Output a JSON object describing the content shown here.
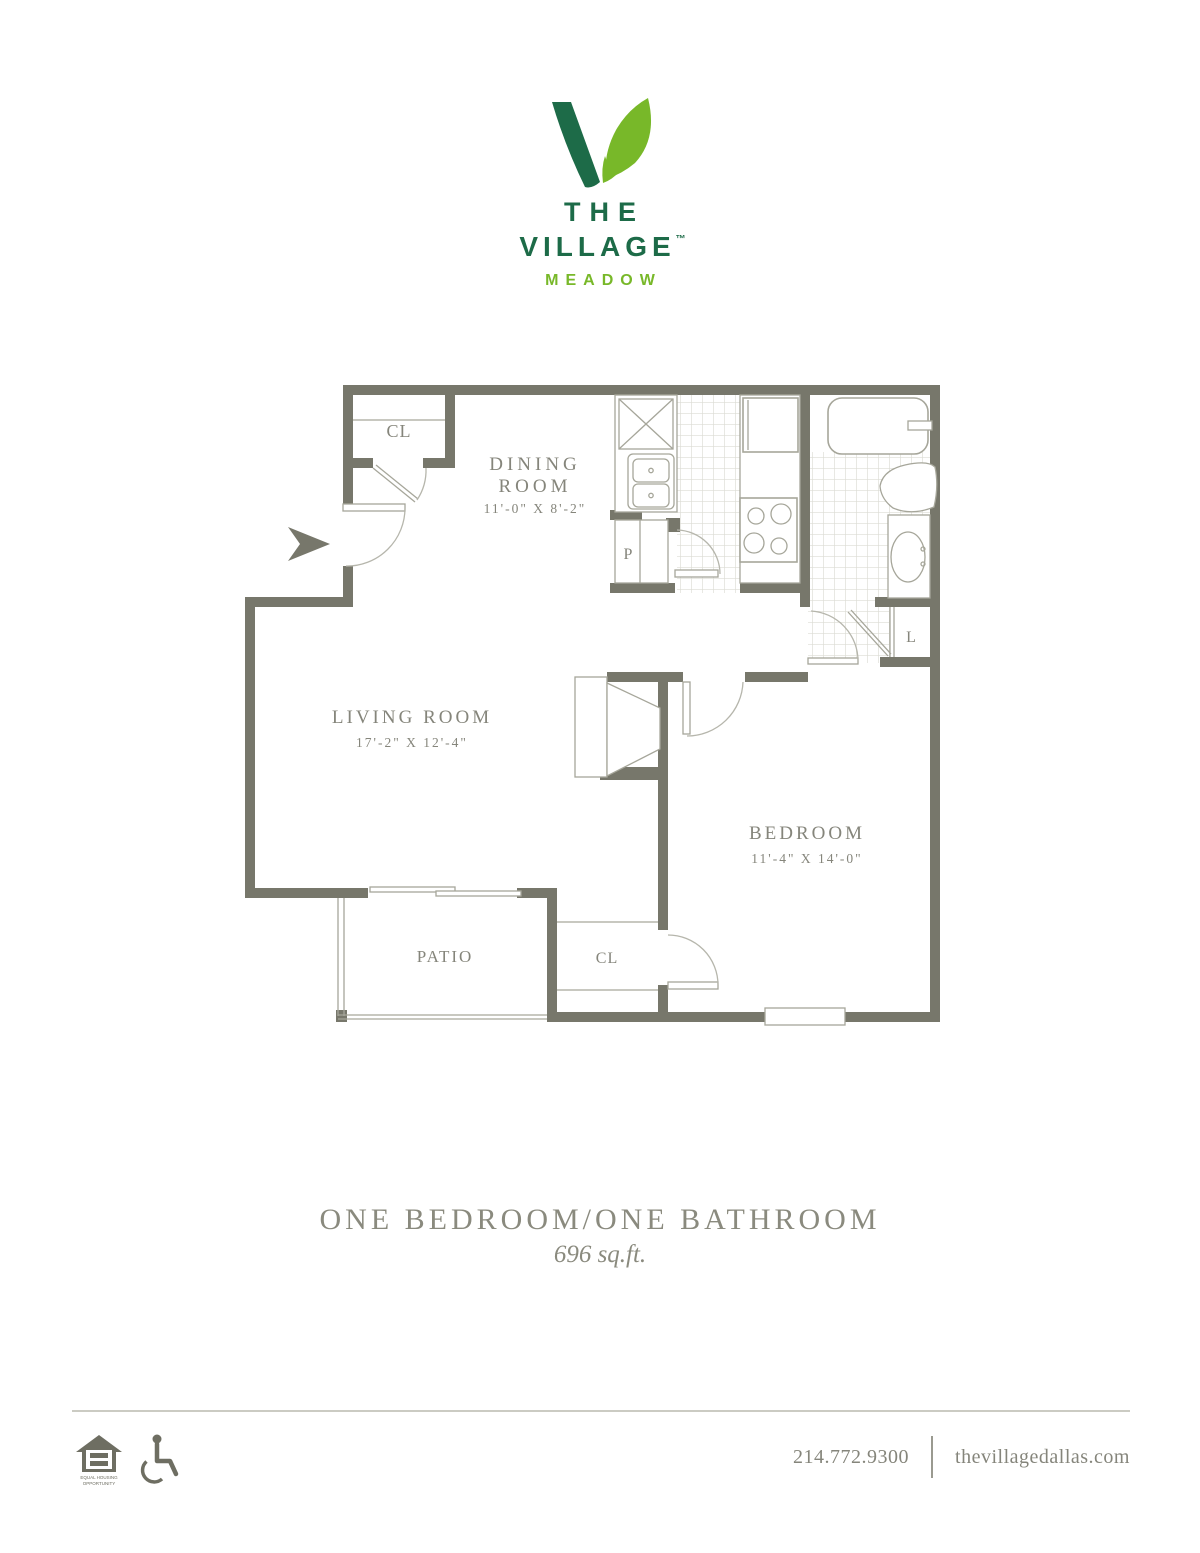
{
  "logo": {
    "the": "THE",
    "village": "VILLAGE",
    "tm": "™",
    "meadow": "MEADOW",
    "dark_green": "#1d6b48",
    "light_green": "#78b829"
  },
  "plan": {
    "wall_color": "#77776b",
    "entry_closet": "CL",
    "dining_line1": "DINING",
    "dining_line2": "ROOM",
    "dining_dims": "11'-0\" X 8'-2\"",
    "pantry": "P",
    "linen": "L",
    "living_name": "LIVING ROOM",
    "living_dims": "17'-2\" X 12'-4\"",
    "bedroom_name": "BEDROOM",
    "bedroom_dims": "11'-4\" X 14'-0\"",
    "bedroom_closet": "CL",
    "patio": "PATIO"
  },
  "title": {
    "main": "ONE BEDROOM/ONE BATHROOM",
    "sqft": "696 sq.ft."
  },
  "footer": {
    "phone": "214.772.9300",
    "website": "thevillagedallas.com",
    "eho_line1": "EQUAL HOUSING",
    "eho_line2": "OPPORTUNITY"
  }
}
